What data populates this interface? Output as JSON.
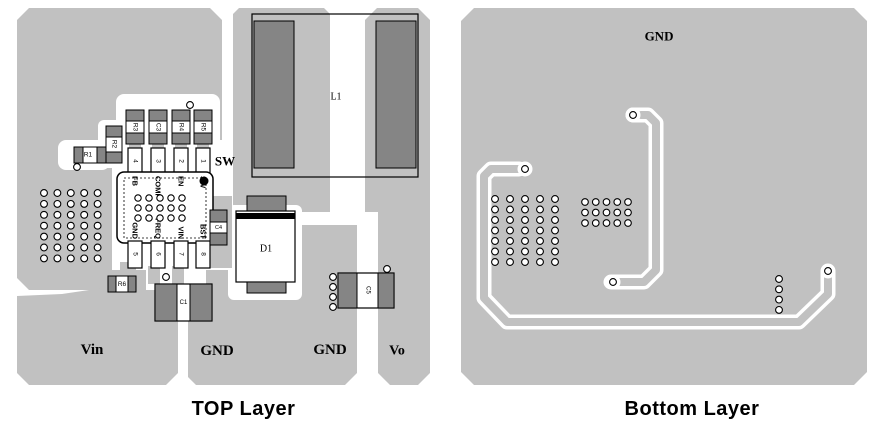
{
  "colors": {
    "plane": "#c1c1c1",
    "pad_dark": "#858585",
    "outline": "#000000",
    "white": "#ffffff"
  },
  "via": {
    "r": 3.4,
    "stroke": 1.1
  },
  "captions": {
    "top": "TOP Layer",
    "bottom": "Bottom Layer"
  },
  "left_board": {
    "name": "top-layer-pcb",
    "planes": [
      {
        "t": "poly",
        "pts": "29,8 210,8 222,20 222,268 206,268 206,272 112,272 112,290 29,290 17,278 17,20",
        "n": "plane-upper-left"
      },
      {
        "t": "poly",
        "pts": "239,8 324,8 330,14 330,212 233,212 233,14",
        "n": "plane-sw"
      },
      {
        "t": "poly",
        "pts": "377,8 418,8 430,20 430,373 418,385 390,385 378,373 378,225 365,215 365,20",
        "n": "plane-vo"
      },
      {
        "t": "poly",
        "pts": "188,284 204,270 302,270 302,225 357,225 357,373 345,385 196,385 188,377",
        "n": "plane-gnd"
      },
      {
        "t": "poly",
        "pts": "17,296 62,294 143,282 178,282 178,373 166,385 29,385 17,373",
        "n": "plane-vin"
      }
    ],
    "pockets": [
      {
        "t": "rect",
        "x": 116,
        "y": 94,
        "w": 104,
        "h": 56,
        "rx": 8
      },
      {
        "t": "rect",
        "x": 98,
        "y": 120,
        "w": 26,
        "h": 48,
        "rx": 6
      },
      {
        "t": "rect",
        "x": 58,
        "y": 140,
        "w": 52,
        "h": 30,
        "rx": 8
      },
      {
        "t": "rect",
        "x": 192,
        "y": 140,
        "w": 41,
        "h": 56,
        "rx": 8
      },
      {
        "t": "rect",
        "x": 112,
        "y": 150,
        "w": 94,
        "h": 140,
        "rx": 6
      },
      {
        "t": "rect",
        "x": 228,
        "y": 205,
        "w": 74,
        "h": 95,
        "rx": 6
      },
      {
        "t": "rect",
        "x": 302,
        "y": 212,
        "w": 76,
        "h": 13,
        "rx": 0
      }
    ],
    "tabs": [
      {
        "t": "rect",
        "x": 206,
        "y": 196,
        "w": 26,
        "h": 72
      },
      {
        "t": "rect",
        "x": 102,
        "y": 270,
        "w": 44,
        "h": 26
      },
      {
        "t": "rect",
        "x": 120,
        "y": 262,
        "w": 16,
        "h": 12
      },
      {
        "t": "rect",
        "x": 148,
        "y": 266,
        "w": 12,
        "h": 18
      },
      {
        "t": "rect",
        "x": 172,
        "y": 266,
        "w": 12,
        "h": 18
      },
      {
        "t": "rect",
        "x": 129,
        "y": 142,
        "w": 12,
        "h": 10
      },
      {
        "t": "rect",
        "x": 152,
        "y": 142,
        "w": 12,
        "h": 10
      },
      {
        "t": "rect",
        "x": 175,
        "y": 142,
        "w": 12,
        "h": 10
      },
      {
        "t": "rect",
        "x": 197,
        "y": 142,
        "w": 12,
        "h": 10
      }
    ],
    "parts": [
      {
        "t": "rect",
        "x": 252,
        "y": 14,
        "w": 166,
        "h": 163,
        "f": "none",
        "s": 1.2,
        "n": "l1-outline"
      },
      {
        "t": "rect",
        "x": 254,
        "y": 21,
        "w": 40,
        "h": 147,
        "f": "pad",
        "s": 1,
        "n": "l1-pad-left"
      },
      {
        "t": "rect",
        "x": 376,
        "y": 21,
        "w": 40,
        "h": 147,
        "f": "pad",
        "s": 1,
        "n": "l1-pad-right"
      },
      {
        "t": "text",
        "x": 336,
        "y": 97,
        "str": "L1",
        "fs": 10,
        "fam": "serif",
        "n": "l1-label"
      },
      {
        "t": "rect",
        "x": 126,
        "y": 110,
        "w": 18,
        "h": 11,
        "f": "pad",
        "s": 1,
        "n": "r3-pad"
      },
      {
        "t": "rect",
        "x": 126,
        "y": 121,
        "w": 18,
        "h": 12,
        "f": "white",
        "s": 1,
        "n": "r3-body"
      },
      {
        "t": "rect",
        "x": 126,
        "y": 133,
        "w": 18,
        "h": 11,
        "f": "pad",
        "s": 1,
        "n": "r3-pad"
      },
      {
        "t": "text",
        "x": 135,
        "y": 127,
        "str": "R3",
        "fs": 6.5,
        "rot": 90,
        "n": "r3-label"
      },
      {
        "t": "rect",
        "x": 149,
        "y": 110,
        "w": 18,
        "h": 11,
        "f": "pad",
        "s": 1,
        "n": "c3-pad"
      },
      {
        "t": "rect",
        "x": 149,
        "y": 121,
        "w": 18,
        "h": 12,
        "f": "white",
        "s": 1,
        "n": "c3-body"
      },
      {
        "t": "rect",
        "x": 149,
        "y": 133,
        "w": 18,
        "h": 11,
        "f": "pad",
        "s": 1,
        "n": "c3-pad"
      },
      {
        "t": "text",
        "x": 158,
        "y": 127,
        "str": "C3",
        "fs": 6.5,
        "rot": 90,
        "n": "c3-label"
      },
      {
        "t": "rect",
        "x": 172,
        "y": 110,
        "w": 18,
        "h": 11,
        "f": "pad",
        "s": 1,
        "n": "r4-pad"
      },
      {
        "t": "rect",
        "x": 172,
        "y": 121,
        "w": 18,
        "h": 12,
        "f": "white",
        "s": 1,
        "n": "r4-body"
      },
      {
        "t": "rect",
        "x": 172,
        "y": 133,
        "w": 18,
        "h": 11,
        "f": "pad",
        "s": 1,
        "n": "r4-pad"
      },
      {
        "t": "text",
        "x": 181,
        "y": 127,
        "str": "R4",
        "fs": 6.5,
        "rot": 90,
        "n": "r4-label"
      },
      {
        "t": "rect",
        "x": 194,
        "y": 110,
        "w": 18,
        "h": 11,
        "f": "pad",
        "s": 1,
        "n": "r5-pad"
      },
      {
        "t": "rect",
        "x": 194,
        "y": 121,
        "w": 18,
        "h": 12,
        "f": "white",
        "s": 1,
        "n": "r5-body"
      },
      {
        "t": "rect",
        "x": 194,
        "y": 133,
        "w": 18,
        "h": 11,
        "f": "pad",
        "s": 1,
        "n": "r5-pad"
      },
      {
        "t": "text",
        "x": 203,
        "y": 127,
        "str": "R5",
        "fs": 6.5,
        "rot": 90,
        "n": "r5-label"
      },
      {
        "t": "via",
        "x": 190,
        "y": 105
      },
      {
        "t": "rect",
        "x": 106,
        "y": 126,
        "w": 16,
        "h": 11,
        "f": "pad",
        "s": 1,
        "n": "r2-pad"
      },
      {
        "t": "rect",
        "x": 106,
        "y": 137,
        "w": 16,
        "h": 15,
        "f": "white",
        "s": 1,
        "n": "r2-body"
      },
      {
        "t": "rect",
        "x": 106,
        "y": 152,
        "w": 16,
        "h": 11,
        "f": "pad",
        "s": 1,
        "n": "r2-pad"
      },
      {
        "t": "text",
        "x": 114,
        "y": 144,
        "str": "R2",
        "fs": 6.5,
        "rot": 90,
        "n": "r2-label"
      },
      {
        "t": "rect",
        "x": 74,
        "y": 147,
        "w": 32,
        "h": 16,
        "f": "white",
        "s": 1,
        "n": "r1-body"
      },
      {
        "t": "rect",
        "x": 74,
        "y": 147,
        "w": 9,
        "h": 16,
        "f": "pad",
        "s": 1,
        "n": "r1-pad"
      },
      {
        "t": "rect",
        "x": 97,
        "y": 147,
        "w": 9,
        "h": 16,
        "f": "pad",
        "s": 1,
        "n": "r1-pad"
      },
      {
        "t": "text",
        "x": 88,
        "y": 155,
        "str": "R1",
        "fs": 6.5,
        "n": "r1-label"
      },
      {
        "t": "via",
        "x": 77,
        "y": 167
      },
      {
        "t": "rect",
        "x": 128,
        "y": 148,
        "w": 14,
        "h": 27,
        "f": "white",
        "s": 1.2,
        "n": "ic-pad-4"
      },
      {
        "t": "rect",
        "x": 151,
        "y": 148,
        "w": 14,
        "h": 27,
        "f": "white",
        "s": 1.2,
        "n": "ic-pad-3"
      },
      {
        "t": "rect",
        "x": 174,
        "y": 148,
        "w": 14,
        "h": 27,
        "f": "white",
        "s": 1.2,
        "n": "ic-pad-2"
      },
      {
        "t": "rect",
        "x": 196,
        "y": 148,
        "w": 14,
        "h": 27,
        "f": "white",
        "s": 1.2,
        "n": "ic-pad-1"
      },
      {
        "t": "text",
        "x": 135,
        "y": 161,
        "str": "4",
        "fs": 6.5,
        "rot": 90
      },
      {
        "t": "text",
        "x": 158,
        "y": 161,
        "str": "3",
        "fs": 6.5,
        "rot": 90
      },
      {
        "t": "text",
        "x": 181,
        "y": 161,
        "str": "2",
        "fs": 6.5,
        "rot": 90
      },
      {
        "t": "text",
        "x": 203,
        "y": 161,
        "str": "1",
        "fs": 6.5,
        "rot": 90
      },
      {
        "t": "rect",
        "x": 117,
        "y": 172,
        "w": 96,
        "h": 71,
        "rx": 7,
        "f": "white",
        "s": 1.5,
        "n": "ic-body"
      },
      {
        "t": "rect",
        "x": 124,
        "y": 178,
        "w": 82,
        "h": 60,
        "f": "none",
        "s": 0.8,
        "dash": "2,2",
        "n": "ic-inner-outline"
      },
      {
        "t": "circle",
        "x": 204,
        "y": 181,
        "r": 4.5,
        "f": "black",
        "n": "ic-pin1-dot"
      },
      {
        "t": "text",
        "x": 135,
        "y": 176,
        "str": "FB",
        "fs": 7.5,
        "b": true,
        "rot": 90,
        "anchor": "start",
        "n": "ic-pin-fb"
      },
      {
        "t": "text",
        "x": 158,
        "y": 176,
        "str": "COMP",
        "fs": 7.5,
        "b": true,
        "rot": 90,
        "anchor": "start",
        "n": "ic-pin-comp"
      },
      {
        "t": "text",
        "x": 181,
        "y": 176,
        "str": "EN",
        "fs": 7.5,
        "b": true,
        "rot": 90,
        "anchor": "start",
        "n": "ic-pin-en"
      },
      {
        "t": "text",
        "x": 203,
        "y": 176,
        "str": "SW",
        "fs": 7.5,
        "b": true,
        "rot": 90,
        "anchor": "start",
        "n": "ic-pin-sw"
      },
      {
        "t": "text",
        "x": 135,
        "y": 239,
        "str": "GND",
        "fs": 7.5,
        "b": true,
        "rot": 90,
        "anchor": "end",
        "n": "ic-pin-gnd"
      },
      {
        "t": "text",
        "x": 158,
        "y": 239,
        "str": "FREQ",
        "fs": 7.5,
        "b": true,
        "rot": 90,
        "anchor": "end",
        "n": "ic-pin-freq"
      },
      {
        "t": "text",
        "x": 181,
        "y": 239,
        "str": "VIN",
        "fs": 7.5,
        "b": true,
        "rot": 90,
        "anchor": "end",
        "n": "ic-pin-vin"
      },
      {
        "t": "text",
        "x": 203,
        "y": 239,
        "str": "BST",
        "fs": 7.5,
        "b": true,
        "rot": 90,
        "anchor": "end",
        "n": "ic-pin-bst"
      },
      {
        "t": "rect",
        "x": 128,
        "y": 241,
        "w": 14,
        "h": 27,
        "f": "white",
        "s": 1.2,
        "n": "ic-pad-5"
      },
      {
        "t": "rect",
        "x": 151,
        "y": 241,
        "w": 14,
        "h": 27,
        "f": "white",
        "s": 1.2,
        "n": "ic-pad-6"
      },
      {
        "t": "rect",
        "x": 174,
        "y": 241,
        "w": 14,
        "h": 27,
        "f": "white",
        "s": 1.2,
        "n": "ic-pad-7"
      },
      {
        "t": "rect",
        "x": 196,
        "y": 241,
        "w": 14,
        "h": 27,
        "f": "white",
        "s": 1.2,
        "n": "ic-pad-8"
      },
      {
        "t": "text",
        "x": 135,
        "y": 254,
        "str": "5",
        "fs": 6.5,
        "rot": 90
      },
      {
        "t": "text",
        "x": 158,
        "y": 254,
        "str": "6",
        "fs": 6.5,
        "rot": 90
      },
      {
        "t": "text",
        "x": 181,
        "y": 254,
        "str": "7",
        "fs": 6.5,
        "rot": 90
      },
      {
        "t": "text",
        "x": 203,
        "y": 254,
        "str": "8",
        "fs": 6.5,
        "rot": 90
      },
      {
        "t": "rect",
        "x": 210,
        "y": 210,
        "w": 17,
        "h": 12,
        "f": "pad",
        "s": 1,
        "n": "c4-pad"
      },
      {
        "t": "rect",
        "x": 210,
        "y": 222,
        "w": 17,
        "h": 11,
        "f": "white",
        "s": 1,
        "n": "c4-body"
      },
      {
        "t": "rect",
        "x": 210,
        "y": 233,
        "w": 17,
        "h": 12,
        "f": "pad",
        "s": 1,
        "n": "c4-pad"
      },
      {
        "t": "text",
        "x": 218.5,
        "y": 228,
        "str": "C4",
        "fs": 5.5,
        "n": "c4-label"
      },
      {
        "t": "rect",
        "x": 247,
        "y": 196,
        "w": 39,
        "h": 15,
        "f": "pad",
        "s": 1,
        "n": "d1-pad-top"
      },
      {
        "t": "rect",
        "x": 236,
        "y": 211,
        "w": 59,
        "h": 71,
        "f": "white",
        "s": 1.2,
        "n": "d1-body"
      },
      {
        "t": "rect",
        "x": 236,
        "y": 213,
        "w": 59,
        "h": 6,
        "f": "black",
        "n": "d1-cathode-band"
      },
      {
        "t": "rect",
        "x": 247,
        "y": 282,
        "w": 39,
        "h": 11,
        "f": "pad",
        "s": 1,
        "n": "d1-pad-bottom"
      },
      {
        "t": "text",
        "x": 266,
        "y": 249,
        "str": "D1",
        "fs": 10,
        "fam": "serif",
        "n": "d1-label"
      },
      {
        "t": "rect",
        "x": 108,
        "y": 276,
        "w": 28,
        "h": 16,
        "f": "white",
        "s": 1,
        "n": "r6-body"
      },
      {
        "t": "rect",
        "x": 108,
        "y": 276,
        "w": 8,
        "h": 16,
        "f": "pad",
        "s": 1,
        "n": "r6-pad"
      },
      {
        "t": "rect",
        "x": 128,
        "y": 276,
        "w": 8,
        "h": 16,
        "f": "pad",
        "s": 1,
        "n": "r6-pad"
      },
      {
        "t": "text",
        "x": 122,
        "y": 284.5,
        "str": "R6",
        "fs": 6.5,
        "n": "r6-label"
      },
      {
        "t": "via",
        "x": 166,
        "y": 277
      },
      {
        "t": "rect",
        "x": 155,
        "y": 284,
        "w": 57,
        "h": 37,
        "f": "white",
        "s": 1.2,
        "n": "c1-body"
      },
      {
        "t": "rect",
        "x": 155,
        "y": 284,
        "w": 22,
        "h": 37,
        "f": "pad",
        "s": 1,
        "n": "c1-pad"
      },
      {
        "t": "rect",
        "x": 190,
        "y": 284,
        "w": 22,
        "h": 37,
        "f": "pad",
        "s": 1,
        "n": "c1-pad"
      },
      {
        "t": "text",
        "x": 183.5,
        "y": 303,
        "str": "C1",
        "fs": 6,
        "n": "c1-label"
      },
      {
        "t": "rect",
        "x": 338,
        "y": 273,
        "w": 56,
        "h": 35,
        "f": "white",
        "s": 1.2,
        "n": "c5-body"
      },
      {
        "t": "rect",
        "x": 338,
        "y": 273,
        "w": 19,
        "h": 35,
        "f": "pad",
        "s": 1,
        "n": "c5-pad"
      },
      {
        "t": "rect",
        "x": 378,
        "y": 273,
        "w": 16,
        "h": 35,
        "f": "pad",
        "s": 1,
        "n": "c5-pad"
      },
      {
        "t": "text",
        "x": 367.5,
        "y": 290,
        "str": "C5",
        "fs": 6,
        "rot": 90,
        "n": "c5-label"
      },
      {
        "t": "via",
        "x": 333,
        "y": 277
      },
      {
        "t": "via",
        "x": 333,
        "y": 287
      },
      {
        "t": "via",
        "x": 333,
        "y": 297
      },
      {
        "t": "via",
        "x": 333,
        "y": 307
      },
      {
        "t": "via",
        "x": 387,
        "y": 269
      }
    ],
    "via_grids": [
      {
        "x0": 44,
        "y0": 193,
        "dx": 13.4,
        "dy": 10.9,
        "cols": 5,
        "rows": 7,
        "r": 3.4,
        "n": "via-array-left"
      },
      {
        "x0": 138,
        "y0": 198,
        "dx": 11,
        "dy": 10,
        "cols": 5,
        "rows": 3,
        "r": 3.2,
        "n": "via-array-ic"
      }
    ],
    "labels": [
      {
        "t": "text",
        "x": 225,
        "y": 161,
        "str": "SW",
        "fs": 13,
        "b": true,
        "fam": "serif",
        "n": "net-label-sw"
      },
      {
        "t": "text",
        "x": 92,
        "y": 350,
        "str": "Vin",
        "fs": 15,
        "b": true,
        "fam": "serif",
        "n": "net-label-vin"
      },
      {
        "t": "text",
        "x": 217,
        "y": 351,
        "str": "GND",
        "fs": 15,
        "b": true,
        "fam": "serif",
        "n": "net-label-gnd-1"
      },
      {
        "t": "text",
        "x": 330,
        "y": 350,
        "str": "GND",
        "fs": 15,
        "b": true,
        "fam": "serif",
        "n": "net-label-gnd-2"
      },
      {
        "t": "text",
        "x": 397,
        "y": 351,
        "str": "Vo",
        "fs": 14,
        "b": true,
        "fam": "serif",
        "n": "net-label-vo"
      }
    ]
  },
  "right_board": {
    "name": "bottom-layer-pcb",
    "planes": [
      {
        "t": "poly",
        "pts": "31,8 411,8 424,21 424,372 411,385 31,385 18,372 18,21",
        "n": "plane-bottom-gnd"
      }
    ],
    "traces": [
      {
        "white": "M76 169 L48 169 L41 176 L41 298 L64 322 L356 322 L385 294 L385 272",
        "gray": "M88 169 L48 169 L41 176 L41 298 L64 322 L356 322 L385 294 L385 262",
        "vias": [
          [
            82,
            169
          ],
          [
            385,
            271
          ]
        ],
        "n": "trace-a"
      },
      {
        "white": "M190 115 L205 115 L213 123 L213 270 L201 282 L168 282",
        "gray": "M198 115 L205 115 L213 123 L213 270 L201 282 L176 282",
        "vias": [
          [
            190,
            115
          ],
          [
            170,
            282
          ]
        ],
        "n": "trace-b"
      }
    ],
    "via_grids": [
      {
        "x0": 52,
        "y0": 199,
        "dx": 15,
        "dy": 10.5,
        "cols": 5,
        "rows": 7,
        "r": 3.4,
        "n": "via-array-left"
      },
      {
        "x0": 142,
        "y0": 202,
        "dx": 10.75,
        "dy": 10.5,
        "cols": 5,
        "rows": 3,
        "r": 3.3,
        "n": "via-array-mid"
      },
      {
        "x0": 336,
        "y0": 279,
        "dx": 0,
        "dy": 10.3,
        "cols": 1,
        "rows": 4,
        "r": 3.4,
        "n": "via-column-c5"
      }
    ],
    "labels": [
      {
        "t": "text",
        "x": 216,
        "y": 36,
        "str": "GND",
        "fs": 13,
        "b": true,
        "fam": "serif",
        "n": "net-label-gnd"
      }
    ]
  }
}
